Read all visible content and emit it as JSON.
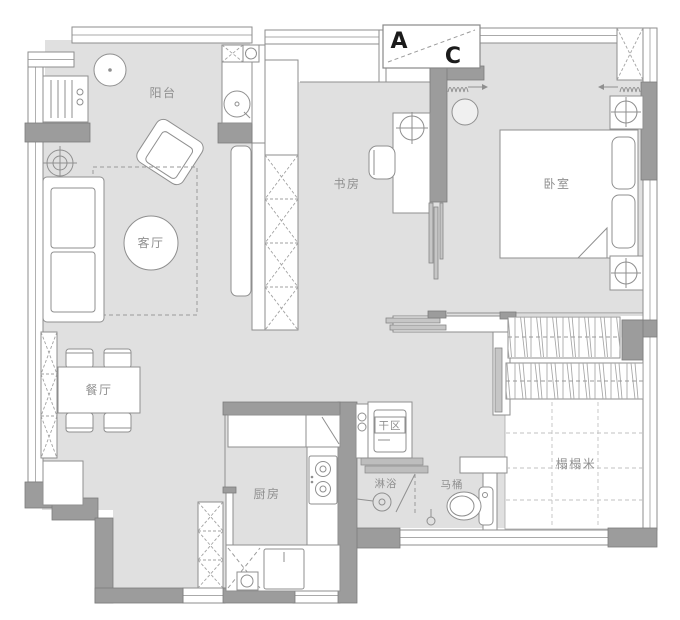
{
  "plan": {
    "title": "apartment-floor-plan",
    "markers": {
      "ac_a": "A",
      "ac_c": "C"
    },
    "rooms": {
      "balcony": "阳台",
      "living": "客厅",
      "dining": "餐厅",
      "study": "书房",
      "bedroom": "卧室",
      "kitchen": "厨房",
      "dry_area": "干区",
      "shower": "淋浴",
      "toilet": "马桶",
      "tatami": "榻榻米"
    },
    "colors": {
      "floor": "#e0e0e0",
      "wall": "#9c9c9c",
      "text": "#8f8f8f",
      "marker_text": "#1b1b1b"
    }
  }
}
